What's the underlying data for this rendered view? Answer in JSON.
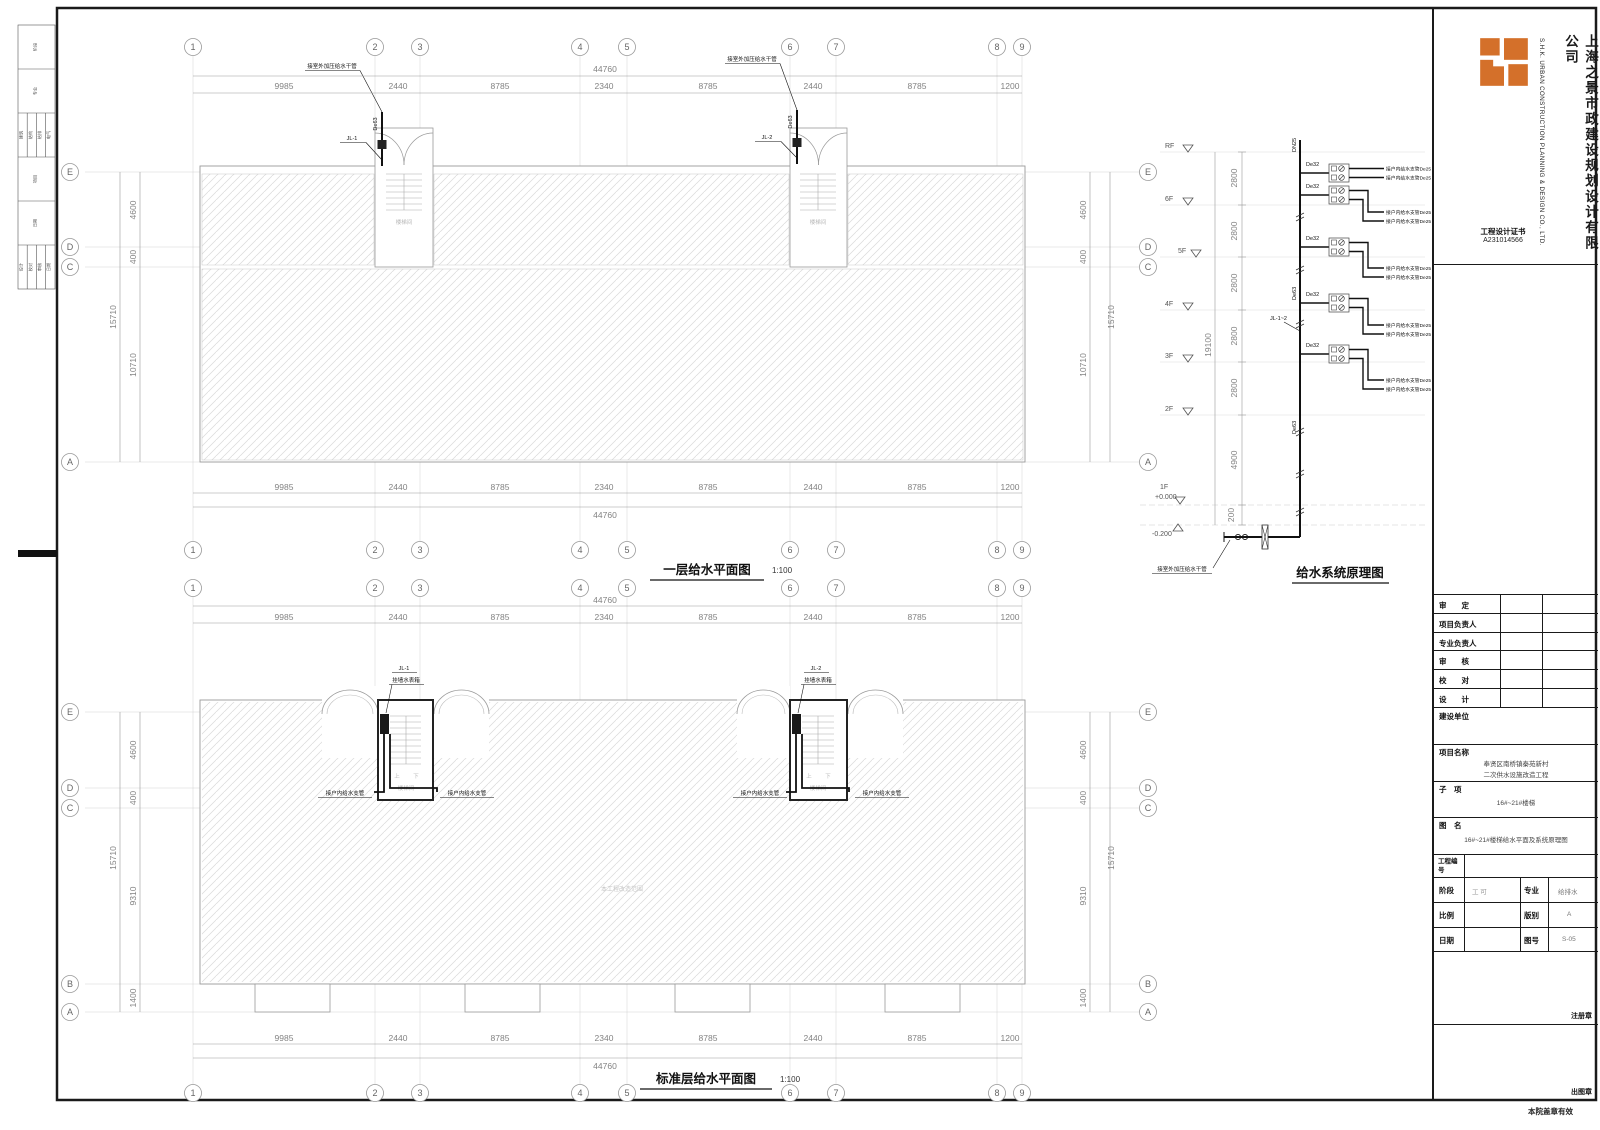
{
  "company": {
    "name_cn": "上海之景市政建设规划设计有限公司",
    "name_en": "S.H.K. URBAN CONSTRUCTION PLANNING & DESIGN CO., LTD.",
    "cert_label": "工程设计证书",
    "cert_no": "A231014566"
  },
  "title_block": {
    "approve": "审　　定",
    "project_lead": "项目负责人",
    "discipline_lead": "专业负责人",
    "review": "审　　核",
    "proof": "校　　对",
    "design": "设　　计",
    "client_label": "建设单位",
    "project_label": "项目名称",
    "project_line1": "奉贤区南桥镇秦苑新村",
    "project_line2": "二次供水设施改造工程",
    "sub_label": "子　项",
    "sub_value": "16#~21#楼梯",
    "drawing_label": "图　名",
    "drawing_value": "16#~21#楼梯给水平面及系统原理图",
    "job_no_label": "工程编号",
    "stage_label": "阶段",
    "stage_value": "工 可",
    "major_label": "专业",
    "major_value": "给排水",
    "scale_label": "比例",
    "edition_label": "版别",
    "edition_value": "A",
    "date_label": "日期",
    "no_label": "图号",
    "no_value": "S-05",
    "stamp_registration": "注册章",
    "stamp_issue": "出图章",
    "valid_note": "本院盖章有效"
  },
  "strip": {
    "r1": "阶段",
    "r2": "专业",
    "r3": [
      "建筑",
      "结构",
      "给排",
      "电气"
    ],
    "r4": "项目",
    "r5": "日期",
    "r6": [
      "设计",
      "校对",
      "审核",
      "日期"
    ]
  },
  "grid": {
    "cols": [
      "1",
      "2",
      "3",
      "4",
      "5",
      "6",
      "7",
      "8",
      "9"
    ],
    "rows_plan1": [
      "E",
      "D",
      "C",
      "A"
    ],
    "rows_plan2": [
      "E",
      "D",
      "C",
      "B",
      "A"
    ]
  },
  "dims": {
    "h": [
      "9985",
      "2440",
      "8785",
      "2340",
      "8785",
      "2440",
      "8785",
      "1200"
    ],
    "h_total": "44760",
    "p1_left": [
      "4600",
      "400",
      "10710"
    ],
    "p1_total": "15710",
    "p2_left": [
      "4600",
      "400",
      "9310",
      "1400"
    ],
    "p2_total": "15710"
  },
  "plan1": {
    "title": "一层给水平面图",
    "scale": "1:100",
    "outdoor_main": "接室外加压给水干管",
    "riser1": "JL-1",
    "riser2": "JL-2",
    "pipe": "De63",
    "stair": "楼梯间"
  },
  "plan2": {
    "title": "标准层给水平面图",
    "scale": "1:100",
    "riser1": "JL-1",
    "riser2": "JL-2",
    "meter_box": "挂墙水表箱",
    "branch": "接户内给水支管",
    "stair": "楼梯间",
    "up": "上",
    "down": "下",
    "scope": "本工程改造范围"
  },
  "schematic": {
    "title": "给水系统原理图",
    "floors": [
      "RF",
      "6F",
      "5F",
      "4F",
      "3F",
      "2F"
    ],
    "f1": "1F",
    "lvl_up": "+0.000",
    "lvl_dn": "-0.200",
    "v_dims": [
      "2800",
      "2800",
      "2800",
      "2800",
      "2800",
      "4900",
      "200"
    ],
    "v_total": "19100",
    "riser_top": "DN25",
    "branch_pipe": "De32",
    "main_pipe": "De63",
    "riser_name": "JL-1~2",
    "unit_branch": "接户内给水支管De25",
    "outdoor_main": "接室外加压给水干管"
  }
}
